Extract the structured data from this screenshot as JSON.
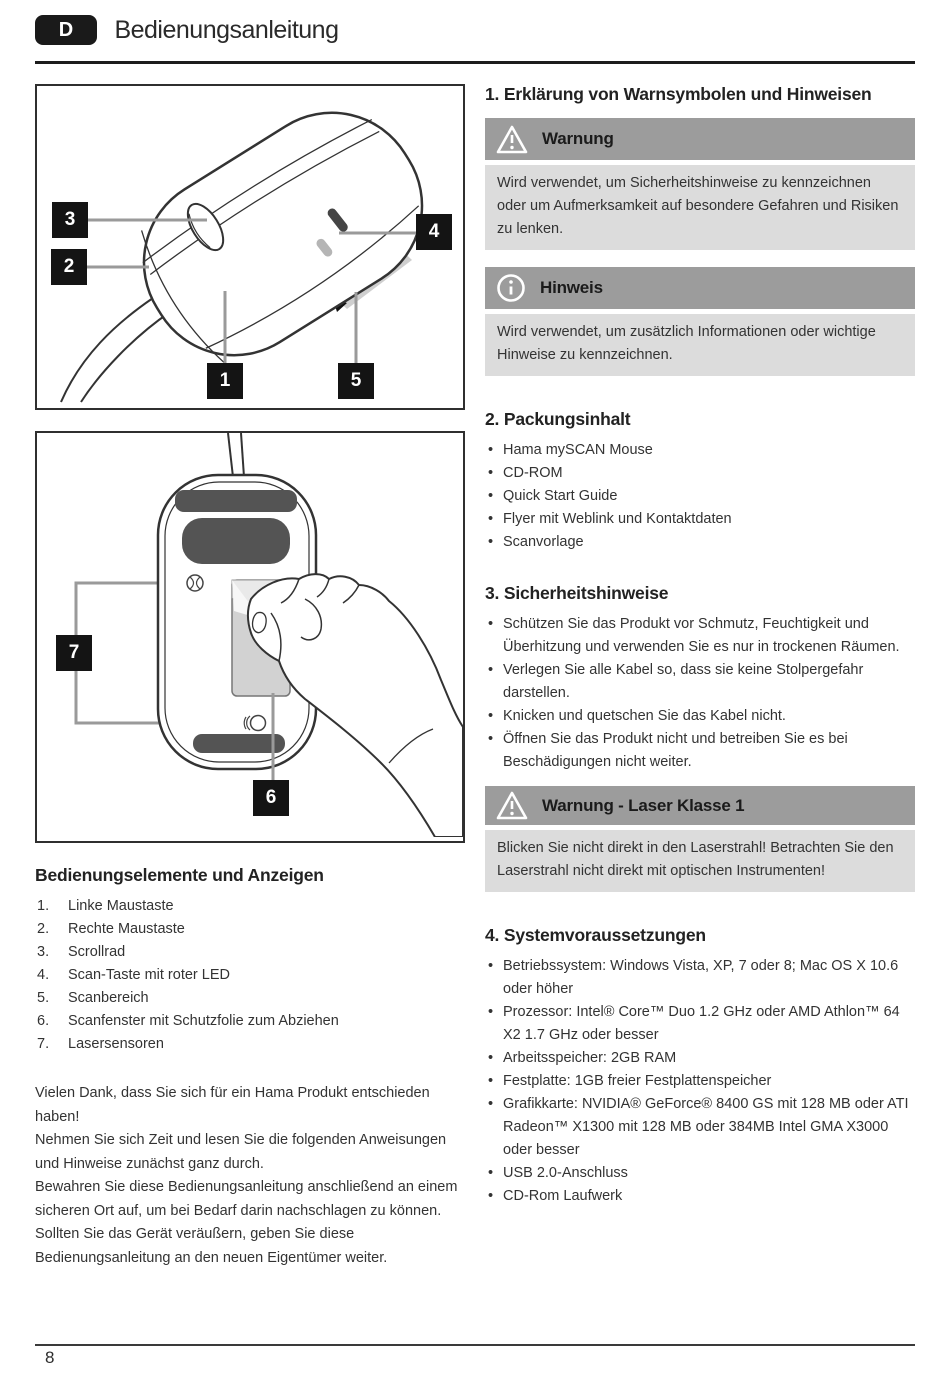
{
  "ui": {
    "bullet": "•"
  },
  "header": {
    "lang_badge": "D",
    "title": "Bedienungsanleitung"
  },
  "page": {
    "number": "8"
  },
  "figures": {
    "fig1": {
      "c1": "1",
      "c2": "2",
      "c3": "3",
      "c4": "4",
      "c5": "5"
    },
    "fig2": {
      "c6": "6",
      "c7": "7"
    }
  },
  "controls": {
    "title": "Bedienungselemente und Anzeigen",
    "items": [
      {
        "num": "1.",
        "label": "Linke Maustaste"
      },
      {
        "num": "2.",
        "label": "Rechte Maustaste"
      },
      {
        "num": "3.",
        "label": "Scrollrad"
      },
      {
        "num": "4.",
        "label": "Scan-Taste mit roter LED"
      },
      {
        "num": "5.",
        "label": "Scanbereich"
      },
      {
        "num": "6.",
        "label": "Scanfenster mit Schutzfolie zum Abziehen"
      },
      {
        "num": "7.",
        "label": "Lasersensoren"
      }
    ]
  },
  "intro": {
    "paragraphs": [
      "Vielen Dank, dass Sie sich für ein Hama Produkt entschieden haben!",
      "Nehmen Sie sich Zeit und lesen Sie die folgenden Anweisungen und Hinweise zunächst ganz durch.",
      "Bewahren Sie diese Bedienungsanleitung anschließend an einem sicheren Ort auf, um bei Bedarf darin nachschlagen zu können. Sollten Sie das Gerät veräußern, geben Sie diese Bedienungsanleitung an den neuen Eigentümer weiter."
    ]
  },
  "sections": {
    "s1": {
      "title": "1. Erklärung von Warnsymbolen und Hinweisen",
      "warning": {
        "label": "Warnung",
        "body": "Wird verwendet, um Sicherheitshinweise zu kennzeichnen oder um Aufmerksamkeit auf besondere Gefahren und Risiken zu lenken."
      },
      "note": {
        "label": "Hinweis",
        "body": "Wird verwendet, um zusätzlich Informationen oder wichtige Hinweise zu kennzeichnen."
      }
    },
    "s2": {
      "title": "2. Packungsinhalt",
      "items": [
        "Hama mySCAN Mouse",
        "CD-ROM",
        "Quick Start Guide",
        "Flyer mit Weblink und Kontaktdaten",
        "Scanvorlage"
      ]
    },
    "s3": {
      "title": "3. Sicherheitshinweise",
      "items": [
        "Schützen Sie das Produkt vor Schmutz, Feuchtigkeit und Überhitzung und verwenden Sie es nur in trockenen Räumen.",
        "Verlegen Sie alle Kabel so, dass sie keine Stolpergefahr darstellen.",
        "Knicken und quetschen Sie das Kabel nicht.",
        "Öffnen Sie das Produkt nicht und betreiben Sie es bei Beschädigungen nicht weiter."
      ],
      "laser_warning": {
        "label": "Warnung - Laser Klasse 1",
        "body": "Blicken Sie nicht direkt in den Laserstrahl! Betrachten Sie den Laserstrahl nicht direkt mit optischen Instrumenten!"
      }
    },
    "s4": {
      "title": "4. Systemvoraussetzungen",
      "items": [
        "Betriebssystem: Windows Vista, XP, 7 oder 8;  Mac OS X 10.6 oder höher",
        "Prozessor: Intel® Core™ Duo 1.2 GHz oder AMD Athlon™ 64 X2 1.7 GHz oder besser",
        "Arbeitsspeicher: 2GB RAM",
        "Festplatte: 1GB freier Festplattenspeicher",
        "Grafikkarte: NVIDIA® GeForce® 8400 GS mit 128 MB oder ATI Radeon™ X1300 mit 128 MB oder 384MB Intel GMA X3000 oder besser",
        "USB 2.0-Anschluss",
        "CD-Rom Laufwerk"
      ]
    }
  },
  "colors": {
    "badge_black": "#1a1a1a",
    "bar_gray": "#9c9c9c",
    "panel_gray": "#dcdcdc",
    "pad_dark": "#545454",
    "beam_gray": "#cfcfcf"
  }
}
